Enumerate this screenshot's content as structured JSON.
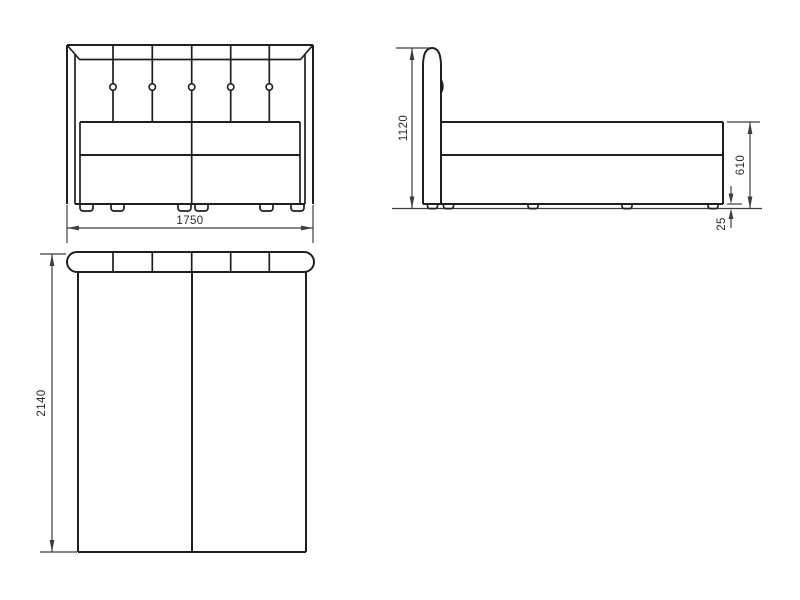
{
  "drawing": {
    "type": "furniture technical drawing - upholstered bed, three orthographic views",
    "views": {
      "front": {
        "name": "front elevation",
        "width_value": "1750",
        "headboard_buttons": 5,
        "headboard_panels": 6,
        "feet_count": 6
      },
      "side": {
        "name": "side elevation",
        "height_value": "1120",
        "body_height_value": "610",
        "feet_height_value": "25",
        "feet_count": 5
      },
      "top": {
        "name": "plan view",
        "length_value": "2140",
        "headboard_segments": 6
      }
    },
    "colors": {
      "line": "#1f1f1f",
      "dim": "#3e3e3e",
      "text": "#2b2b2b",
      "bg": "#ffffff"
    }
  }
}
